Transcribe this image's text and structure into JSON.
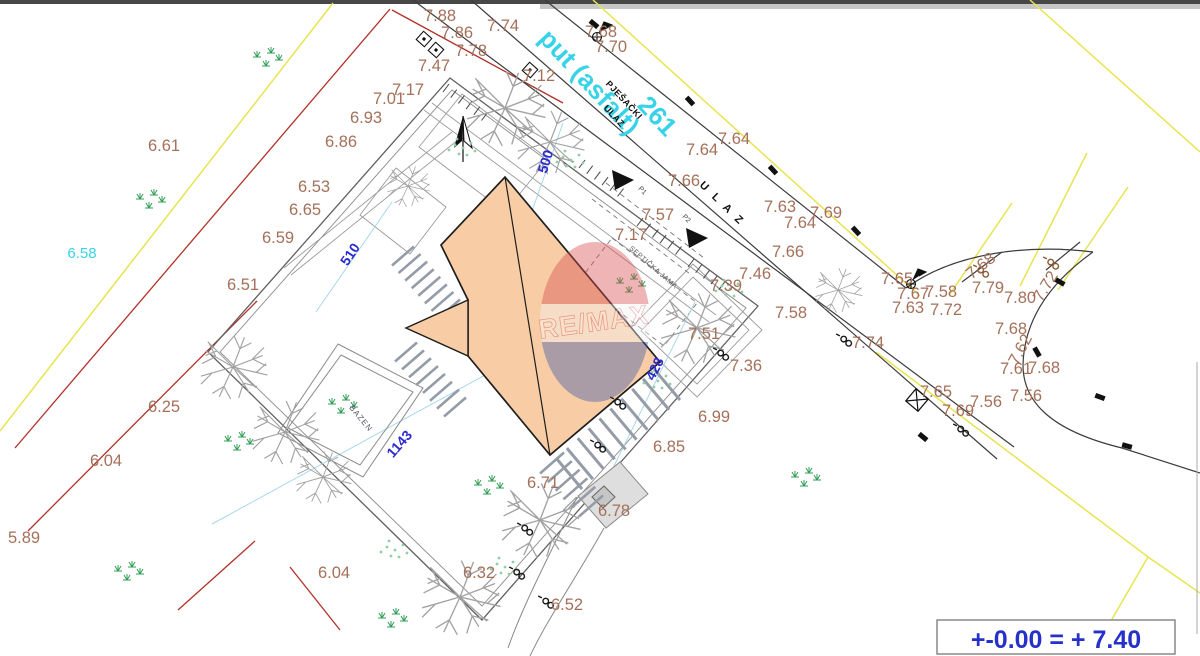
{
  "note": {
    "text": "+-0.00 = + 7.40"
  },
  "watermark": {
    "text": "RE/MAX",
    "top_color": "#d94f52",
    "bottom_color": "#3d5aa8"
  },
  "road": {
    "name": "put (asfalt)",
    "parcel_number": "261"
  },
  "colors": {
    "elevation_text": "#a5705a",
    "road_name": "#38d2e9",
    "dimension": "#2b2bcf",
    "building_fill": "#f8cda6",
    "boundary_yellow": "#e8e44f",
    "boundary_red": "#b13128"
  },
  "labels": [
    {
      "t": "7.88",
      "x": 440,
      "y": 21
    },
    {
      "t": "7.86",
      "x": 457,
      "y": 38
    },
    {
      "t": "7.78",
      "x": 471,
      "y": 56
    },
    {
      "t": "7.74",
      "x": 503,
      "y": 31
    },
    {
      "t": "7.47",
      "x": 434,
      "y": 71
    },
    {
      "t": "7.17",
      "x": 408,
      "y": 95
    },
    {
      "t": "7.01",
      "x": 389,
      "y": 104
    },
    {
      "t": "6.93",
      "x": 366,
      "y": 123
    },
    {
      "t": "6.86",
      "x": 341,
      "y": 147
    },
    {
      "t": "6.61",
      "x": 164,
      "y": 151
    },
    {
      "t": "6.53",
      "x": 314,
      "y": 192
    },
    {
      "t": "6.65",
      "x": 305,
      "y": 215
    },
    {
      "t": "6.59",
      "x": 278,
      "y": 243
    },
    {
      "t": "6.51",
      "x": 243,
      "y": 290
    },
    {
      "t": "6.25",
      "x": 164,
      "y": 412
    },
    {
      "t": "6.04",
      "x": 106,
      "y": 466
    },
    {
      "t": "5.89",
      "x": 24,
      "y": 543
    },
    {
      "t": "6.04",
      "x": 334,
      "y": 578
    },
    {
      "t": "6.32",
      "x": 479,
      "y": 578
    },
    {
      "t": "6.52",
      "x": 567,
      "y": 610
    },
    {
      "t": "6.71",
      "x": 543,
      "y": 488
    },
    {
      "t": "6.78",
      "x": 614,
      "y": 516
    },
    {
      "t": "6.85",
      "x": 669,
      "y": 452
    },
    {
      "t": "6.99",
      "x": 714,
      "y": 422
    },
    {
      "t": "7.36",
      "x": 746,
      "y": 371
    },
    {
      "t": "7.51",
      "x": 704,
      "y": 339
    },
    {
      "t": "7.39",
      "x": 726,
      "y": 291
    },
    {
      "t": "7.58",
      "x": 791,
      "y": 318
    },
    {
      "t": "7.66",
      "x": 788,
      "y": 257
    },
    {
      "t": "7.46",
      "x": 755,
      "y": 279
    },
    {
      "t": "7.66",
      "x": 684,
      "y": 186
    },
    {
      "t": "7.57",
      "x": 658,
      "y": 220
    },
    {
      "t": "7.17",
      "x": 631,
      "y": 240
    },
    {
      "t": "7.12",
      "x": 539,
      "y": 81
    },
    {
      "t": "7.68",
      "x": 601,
      "y": 37
    },
    {
      "t": "7.70",
      "x": 611,
      "y": 52
    },
    {
      "t": "7.64",
      "x": 702,
      "y": 155
    },
    {
      "t": "7.64",
      "x": 734,
      "y": 144
    },
    {
      "t": "7.63",
      "x": 780,
      "y": 212
    },
    {
      "t": "7.69",
      "x": 826,
      "y": 218
    },
    {
      "t": "7.64",
      "x": 800,
      "y": 228
    },
    {
      "t": "7.74",
      "x": 868,
      "y": 348
    },
    {
      "t": "7.65",
      "x": 897,
      "y": 284
    },
    {
      "t": "7.67",
      "x": 913,
      "y": 299
    },
    {
      "t": "7.58",
      "x": 941,
      "y": 297
    },
    {
      "t": "7.79",
      "x": 988,
      "y": 293
    },
    {
      "t": "7.63",
      "x": 908,
      "y": 313
    },
    {
      "t": "7.72",
      "x": 946,
      "y": 315
    },
    {
      "t": "7.80",
      "x": 1020,
      "y": 303
    },
    {
      "t": "7.72",
      "x": 1050,
      "y": 289,
      "r": -58
    },
    {
      "t": "7.68",
      "x": 984,
      "y": 270,
      "r": -38
    },
    {
      "t": "7.68",
      "x": 1011,
      "y": 334
    },
    {
      "t": "7.62",
      "x": 1025,
      "y": 352,
      "r": -62
    },
    {
      "t": "7.61",
      "x": 1016,
      "y": 374
    },
    {
      "t": "7.68",
      "x": 1044,
      "y": 373
    },
    {
      "t": "7.56",
      "x": 986,
      "y": 407
    },
    {
      "t": "7.56",
      "x": 1026,
      "y": 401
    },
    {
      "t": "7.65",
      "x": 936,
      "y": 397
    },
    {
      "t": "7.69",
      "x": 958,
      "y": 416
    },
    {
      "t": "put (asfalt)",
      "x": 583,
      "y": 88,
      "r": 47,
      "c": "cyanbig"
    },
    {
      "t": "261",
      "x": 651,
      "y": 122,
      "r": 47,
      "c": "cyanbig"
    },
    {
      "t": "6.58",
      "x": 82,
      "y": 258,
      "c": "cyansm"
    },
    {
      "t": "500",
      "x": 550,
      "y": 163,
      "r": -73,
      "c": "dim"
    },
    {
      "t": "510",
      "x": 354,
      "y": 257,
      "r": -56,
      "c": "dim"
    },
    {
      "t": "428",
      "x": 659,
      "y": 371,
      "r": -63,
      "c": "dim"
    },
    {
      "t": "1143",
      "x": 403,
      "y": 447,
      "r": -49,
      "c": "dim"
    },
    {
      "t": "PJEŠAČKI",
      "x": 622,
      "y": 102,
      "r": 47,
      "c": "blk"
    },
    {
      "t": "ULAZ",
      "x": 612,
      "y": 118,
      "r": 47,
      "c": "blk"
    },
    {
      "t": "U L A Z",
      "x": 720,
      "y": 206,
      "r": 44,
      "c": "ulaz"
    },
    {
      "t": "SEPTIČKA JAMA",
      "x": 652,
      "y": 269,
      "r": 41,
      "c": "sep"
    },
    {
      "t": "BAZEN",
      "x": 359,
      "y": 420,
      "r": 50,
      "c": "pool"
    },
    {
      "t": "P1",
      "x": 641,
      "y": 192,
      "r": 45,
      "c": "tiny"
    },
    {
      "t": "P2",
      "x": 685,
      "y": 220,
      "r": 45,
      "c": "tiny"
    }
  ],
  "ladders": [
    {
      "x1": 403,
      "y1": 256,
      "x2": 449,
      "y2": 309,
      "n": 8,
      "rx": 22,
      "ry": -19,
      "centered": 1
    },
    {
      "x1": 406,
      "y1": 352,
      "x2": 455,
      "y2": 407,
      "n": 8,
      "rx": 22,
      "ry": -19,
      "centered": 1
    },
    {
      "x1": 556,
      "y1": 458,
      "x2": 654,
      "y2": 369,
      "n": 10,
      "rx": 26,
      "ry": 31,
      "centered": 0
    },
    {
      "x1": 552,
      "y1": 463,
      "x2": 591,
      "y2": 506,
      "n": 6,
      "rx": 24,
      "ry": -21,
      "centered": 1
    }
  ],
  "combs": [
    {
      "x": 449,
      "y": 84,
      "n": 6
    },
    {
      "x": 585,
      "y": 160,
      "n": 6
    },
    {
      "x": 643,
      "y": 218,
      "n": 6
    },
    {
      "x": 694,
      "y": 259,
      "n": 5
    }
  ],
  "trees": [
    [
      505,
      108,
      1
    ],
    [
      550,
      142,
      0.85
    ],
    [
      408,
      186,
      0.55
    ],
    [
      233,
      367,
      0.85
    ],
    [
      285,
      432,
      0.85
    ],
    [
      323,
      477,
      0.7
    ],
    [
      460,
      597,
      1
    ],
    [
      540,
      520,
      1
    ],
    [
      697,
      328,
      0.95
    ],
    [
      838,
      290,
      0.6
    ]
  ],
  "tufts": [
    [
      257,
      57
    ],
    [
      140,
      199
    ],
    [
      620,
      283
    ],
    [
      478,
      485
    ],
    [
      382,
      618
    ],
    [
      228,
      441
    ],
    [
      118,
      571
    ],
    [
      332,
      404
    ],
    [
      795,
      477
    ]
  ],
  "dots": [
    [
      455,
      145
    ],
    [
      563,
      157
    ],
    [
      387,
      547
    ],
    [
      497,
      564
    ],
    [
      722,
      286
    ],
    [
      650,
      378
    ]
  ],
  "poles": [
    [
      846,
      341,
      0
    ],
    [
      963,
      431,
      0
    ],
    [
      723,
      355,
      0
    ],
    [
      620,
      404,
      0
    ],
    [
      600,
      447,
      0
    ],
    [
      527,
      530,
      0
    ],
    [
      519,
      574,
      0
    ],
    [
      548,
      603,
      0
    ],
    [
      983,
      272,
      1
    ],
    [
      1053,
      264,
      1
    ]
  ],
  "culverts": [
    [
      690,
      101,
      47
    ],
    [
      773,
      170,
      47
    ],
    [
      856,
      231,
      47
    ],
    [
      594,
      24,
      40
    ],
    [
      1100,
      397,
      20
    ],
    [
      1037,
      352,
      60
    ],
    [
      1060,
      282,
      30
    ],
    [
      923,
      437,
      40
    ],
    [
      1127,
      446,
      15
    ]
  ],
  "boxes": [
    [
      530,
      70
    ],
    [
      424,
      39
    ],
    [
      436,
      50
    ]
  ],
  "flags": [
    [
      597,
      37
    ],
    [
      911,
      284
    ]
  ],
  "crossboxes": [
    [
      917,
      400
    ]
  ]
}
